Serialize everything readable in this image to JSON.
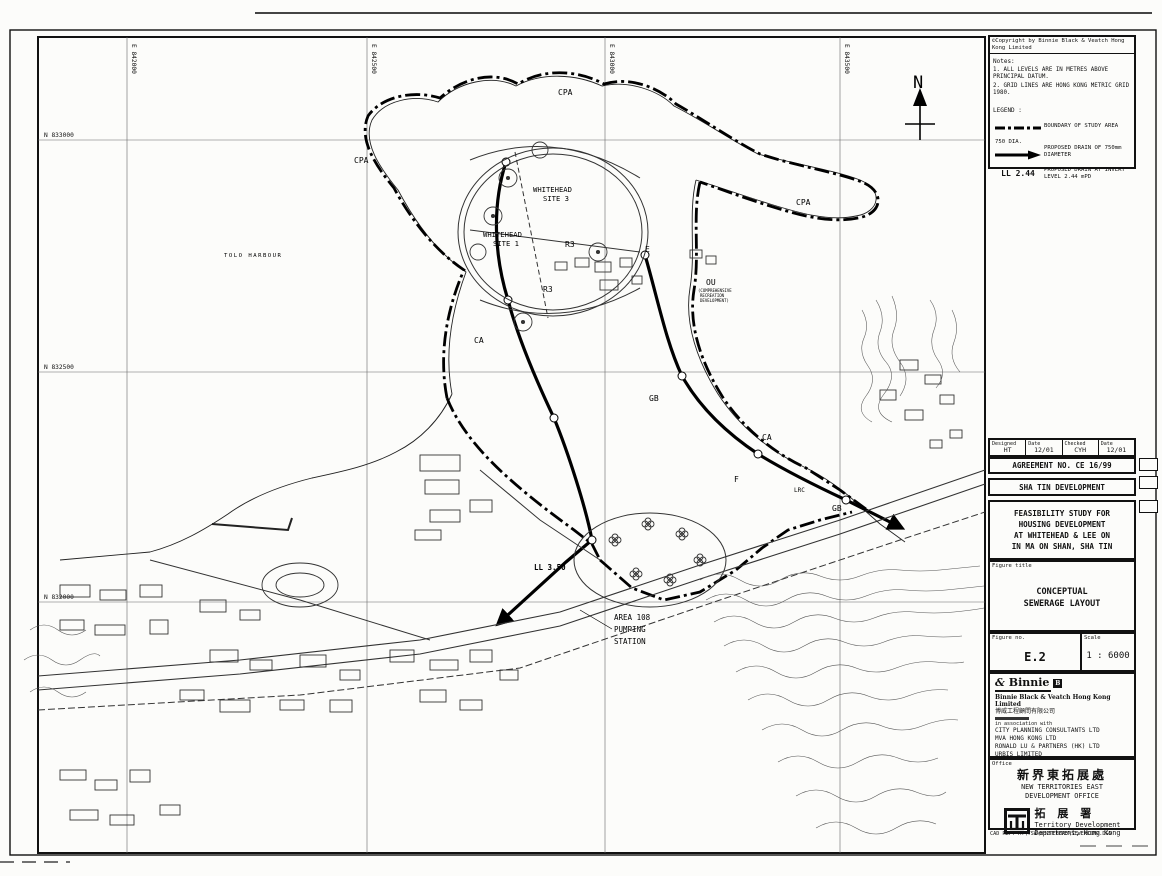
{
  "sheet": {
    "copyright": "©Copyright by Binnie Black & Veatch Hong Kong Limited",
    "cad_ref": "CAD REF. M:\\TSW\\WHITEHEAD\\SEWERCOMP.DGN"
  },
  "notes": {
    "heading": "Notes:",
    "items": [
      "1. ALL LEVELS ARE IN METRES ABOVE PRINCIPAL DATUM.",
      "2. GRID LINES ARE HONG KONG METRIC GRID 1980."
    ]
  },
  "legend": {
    "heading": "LEGEND :",
    "boundary_label": "BOUNDARY OF STUDY AREA",
    "drain_annotation": "750 DIA.",
    "drain_label": "PROPOSED DRAIN OF 750mm DIAMETER",
    "invert_annotation": "LL 2.44",
    "invert_label": "PROPOSED DRAIN AT INVERT LEVEL 2.44 mPD"
  },
  "title_block": {
    "designed_label": "Designed",
    "designed_value": "HT",
    "date1_label": "Date",
    "date1_value": "12/01",
    "checked_label": "Checked",
    "checked_value": "CYH",
    "date2_label": "Date",
    "date2_value": "12/01",
    "agreement": "AGREEMENT NO. CE 16/99",
    "development": "SHA TIN DEVELOPMENT",
    "project_title_lines": [
      "FEASIBILITY STUDY FOR",
      "HOUSING DEVELOPMENT",
      "AT WHITEHEAD & LEE ON",
      "IN MA ON SHAN, SHA TIN"
    ],
    "figure_title_label": "Figure title",
    "figure_title_lines": [
      "CONCEPTUAL",
      "SEWERAGE LAYOUT"
    ],
    "figure_no_label": "Figure no.",
    "figure_no": "E.2",
    "scale_label": "Scale",
    "scale": "1 : 6000"
  },
  "consultants": {
    "logo_amp": "&",
    "logo_name": "Binnie",
    "logo_mark": "B",
    "company": "Binnie Black & Veatch Hong Kong Limited",
    "company_cn": "博威工程顧問有限公司",
    "association": "in association with",
    "firms": [
      "CITY PLANNING CONSULTANTS LTD",
      "MVA HONG KONG LTD",
      "RONALD LU & PARTNERS (HK) LTD",
      "URBIS LIMITED",
      "LARRY H.C. TAM & ASSOCIATES LTD"
    ]
  },
  "office": {
    "label": "Office",
    "office_cn": "新界東拓展處",
    "office_en_lines": [
      "NEW TERRITORIES EAST",
      "DEVELOPMENT OFFICE"
    ],
    "dept_cn": "拓 展 署",
    "dept_en_lines": [
      "Territory Development",
      "Department, Hong Kong"
    ]
  },
  "map": {
    "north": "N",
    "eastings": [
      "E 842000",
      "E 842500",
      "E 843000",
      "E 843500"
    ],
    "northings": [
      "N 833000",
      "N 832500",
      "N 832000"
    ],
    "labels": {
      "cpa": "CPA",
      "whitehead": "WHITEHEAD",
      "site3": "SITE 3",
      "site1": "SITE 1",
      "r3": "R3",
      "e": "E",
      "ou": "OU",
      "ou_sub1": "(COMPREHENSIVE",
      "ou_sub2": "RECREATION",
      "ou_sub3": "DEVELOPMENT)",
      "ca": "CA",
      "gb": "GB",
      "lrc": "LRC",
      "f": "F",
      "tolo_harbour": "TOLO HARBOUR",
      "ll_350": "LL 3.50",
      "area108_1": "AREA 108",
      "area108_2": "PUMPING",
      "area108_3": "STATION"
    }
  }
}
